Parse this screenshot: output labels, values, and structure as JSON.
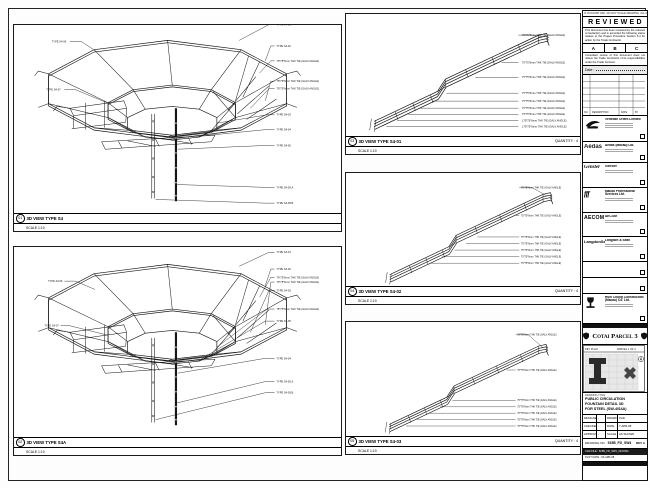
{
  "sheet": {
    "note": "IF IN DOUBT ASK. DO NOT SCALE DRAWING. ALL DIMENSIONS IN MM."
  },
  "stamp": {
    "title": "REVIEWED",
    "body1": "This document has been reviewed by the relevant consultant(s) and is accorded the following status relative to the Project Procedure Section 5.4 for action by the Trade Contractor.",
    "cols": [
      "A",
      "B",
      "C"
    ],
    "body2": "Consultant review of this document does not relieve the Trade Contractor of its responsibilities under the Trade Contract.",
    "date_label": "Date :"
  },
  "revtable": {
    "headers": [
      "NO.",
      "DESCRIPTION",
      "DATE",
      "BY"
    ]
  },
  "consultants": [
    {
      "name": "Venetian Orient Limited"
    },
    {
      "logo_text": "Aedas",
      "name": "Aedas (Macau) Ltd."
    },
    {
      "logo_text": "Gensler",
      "name": "Gensler"
    },
    {
      "logo_text": "fff",
      "name": "Macau Professional Services Ltd."
    },
    {
      "logo_text": "AECOM",
      "name": "AECOM"
    },
    {
      "logo_text": "LangdonSeah",
      "name": "Langdon & Seah"
    }
  ],
  "contractor": {
    "name": "Hsin Chong Construction (Macau) Co. Ltd."
  },
  "project": {
    "title": "Cotai Parcel 3"
  },
  "keyplan": {
    "title": "KEY PLAN",
    "right": "PARCEL 1 OF 3"
  },
  "titleblock": {
    "label": "DRAWING TITLE",
    "lines": [
      "PUBLIC CIRCULATION",
      "FOUNTAIN DETAIL 3D",
      "FOR STEEL (SW-4/S4A)"
    ],
    "rows": [
      [
        "DESIGNED",
        "-",
        "DRAWN",
        "CAD"
      ],
      [
        "CHECKED",
        "-",
        "DATE",
        "7-APR-08"
      ],
      [
        "APPROVED",
        "-",
        "SCALE",
        "AS SHOWN"
      ]
    ],
    "no_label": "DRAWING NO.",
    "no_value": "515B_FD_SW4",
    "rev": "REV A",
    "cad_line": "CAD FILE : 515B_FD_SW4_3D.DWG",
    "plot_line": "PLOT DATE : 04-APR-08"
  },
  "views": {
    "tl": {
      "num": "01",
      "title": "3D VIEW TYPE S4",
      "scale": "SCALE 1:10",
      "right": [
        "TYPE S4-01",
        "TYPE S4-02",
        "75*75*6mm THK TIE (GALV ANGLE)",
        "75*75*6mm THK TIE (GALV ANGLE)",
        "75*75*6mm THK TIE (GALV ANGLE)",
        "TYPE S4-03",
        "TYPE S4-04",
        "TYPE S4-05",
        "TYPE S4-05.A",
        "TYPE S4-05.B"
      ],
      "left": [
        "TYPE S4-06",
        "TYPE S4-07"
      ]
    },
    "bl": {
      "num": "02",
      "title": "3D VIEW TYPE S4A",
      "scale": "SCALE 1:10",
      "right": [
        "TYPE S4-01",
        "TYPE S4-02",
        "75*75*6mm THK TIE (GALV ANGLE)",
        "75*75*6mm THK TIE (GALV ANGLE)",
        "TYPE S4-03",
        "75*75*6mm THK TIE (GALV ANGLE)",
        "TYPE S4-05",
        "TYPE S4-04",
        "TYPE S4-05.A",
        "TYPE S4-05.B"
      ],
      "left": [
        "TYPE S4-06",
        "TYPE S4-07"
      ]
    },
    "r1": {
      "num": "03",
      "title": "3D VIEW TYPE S4-01",
      "qty": "QUANTITY : 4",
      "scale": "SCALE 1:10",
      "callouts": [
        "75*75*6mm THK TIE (GALV ANGLE)",
        "75*75*6mm THK TIE (GALV ANGLE)",
        "75*75*6mm THK TIE (GALV ANGLE)",
        "75*75*6mm THK TIE (GALV ANGLE)",
        "75*75*6mm THK TIE (GALV ANGLE)",
        "75*75*6mm THK TIE (GALV ANGLE)",
        "75*75*6mm THK TIE (GALV ANGLE)",
        "L75*75*6mm THK TIE (GALV ANGLE)",
        "L75*75*6mm THK TIE (GALV ANGLE)"
      ]
    },
    "r2": {
      "num": "04",
      "title": "3D VIEW TYPE S4-02",
      "qty": "QUANTITY : 4",
      "scale": "SCALE 1:10",
      "callouts": [
        "75*75*6mm THK TIE (GALV ANGLE)",
        "75*75*6mm THK TIE (GALV ANGLE)",
        "75*75*6mm THK TIE (GALV ANGLE)",
        "75*75*6mm THK TIE (GALV ANGLE)",
        "75*75*6mm THK TIE (GALV ANGLE)",
        "75*75*6mm THK TIE (GALV ANGLE)",
        "75*75*6mm THK TIE (GALV ANGLE)"
      ]
    },
    "r3": {
      "num": "05",
      "title": "3D VIEW TYPE S4-03",
      "qty": "QUANTITY : 4",
      "scale": "SCALE 1:10",
      "callouts": [
        "75*75*6mm THK TIE (GALV ANGLE)",
        "75*75*6mm THK TIE (GALV ANGLE)",
        "75*75*6mm THK TIE (GALV ANGLE)",
        "75*75*6mm THK TIE (GALV ANGLE)",
        "75*75*6mm THK TIE (GALV ANGLE)",
        "75*75*6mm THK TIE (GALV ANGLE)",
        "75*75*6mm THK TIE (GALV ANGLE)"
      ]
    }
  }
}
